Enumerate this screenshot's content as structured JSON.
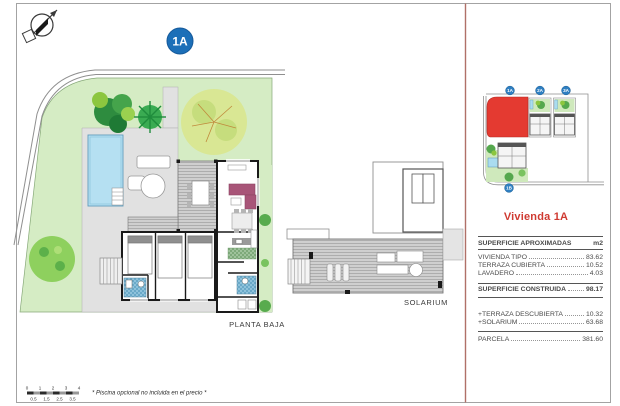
{
  "page": {
    "badge": "1A",
    "floor_label": "PLANTA BAJA",
    "solarium_label": "SOLARIUM",
    "footnote": "* Piscina opcional no incluida en el precio *",
    "colors": {
      "accent_red": "#cf3a31",
      "badge_blue": "#1c6fb8",
      "plot_red": "#e43a31",
      "pool_blue": "#b5e0f2",
      "garden_green": "#d5ecc4"
    }
  },
  "scale_bar": {
    "top": [
      "0",
      "1",
      "2",
      "3",
      "4"
    ],
    "bottom": [
      "0.5",
      "1.5",
      "2.5",
      "3.5"
    ]
  },
  "site_plan": {
    "markers": [
      "1A",
      "2A",
      "3A",
      "1B"
    ]
  },
  "info_panel": {
    "title": "Vivienda 1A",
    "header": {
      "label": "SUPERFICIE APROXIMADAS",
      "unit": "m2"
    },
    "rows": [
      {
        "label": "VIVIENDA TIPO",
        "value": "83.62"
      },
      {
        "label": "TERRAZA CUBIERTA",
        "value": "10.52"
      },
      {
        "label": "LAVADERO",
        "value": "4.03"
      }
    ],
    "total": {
      "label": "SUPERFICIE CONSTRUIDA",
      "value": "98.17"
    },
    "extras": [
      {
        "label": "+TERRAZA DESCUBIERTA",
        "value": "10.32"
      },
      {
        "label": "+SOLARIUM",
        "value": "63.68"
      }
    ],
    "parcel": {
      "label": "PARCELA",
      "value": "381.60"
    }
  }
}
